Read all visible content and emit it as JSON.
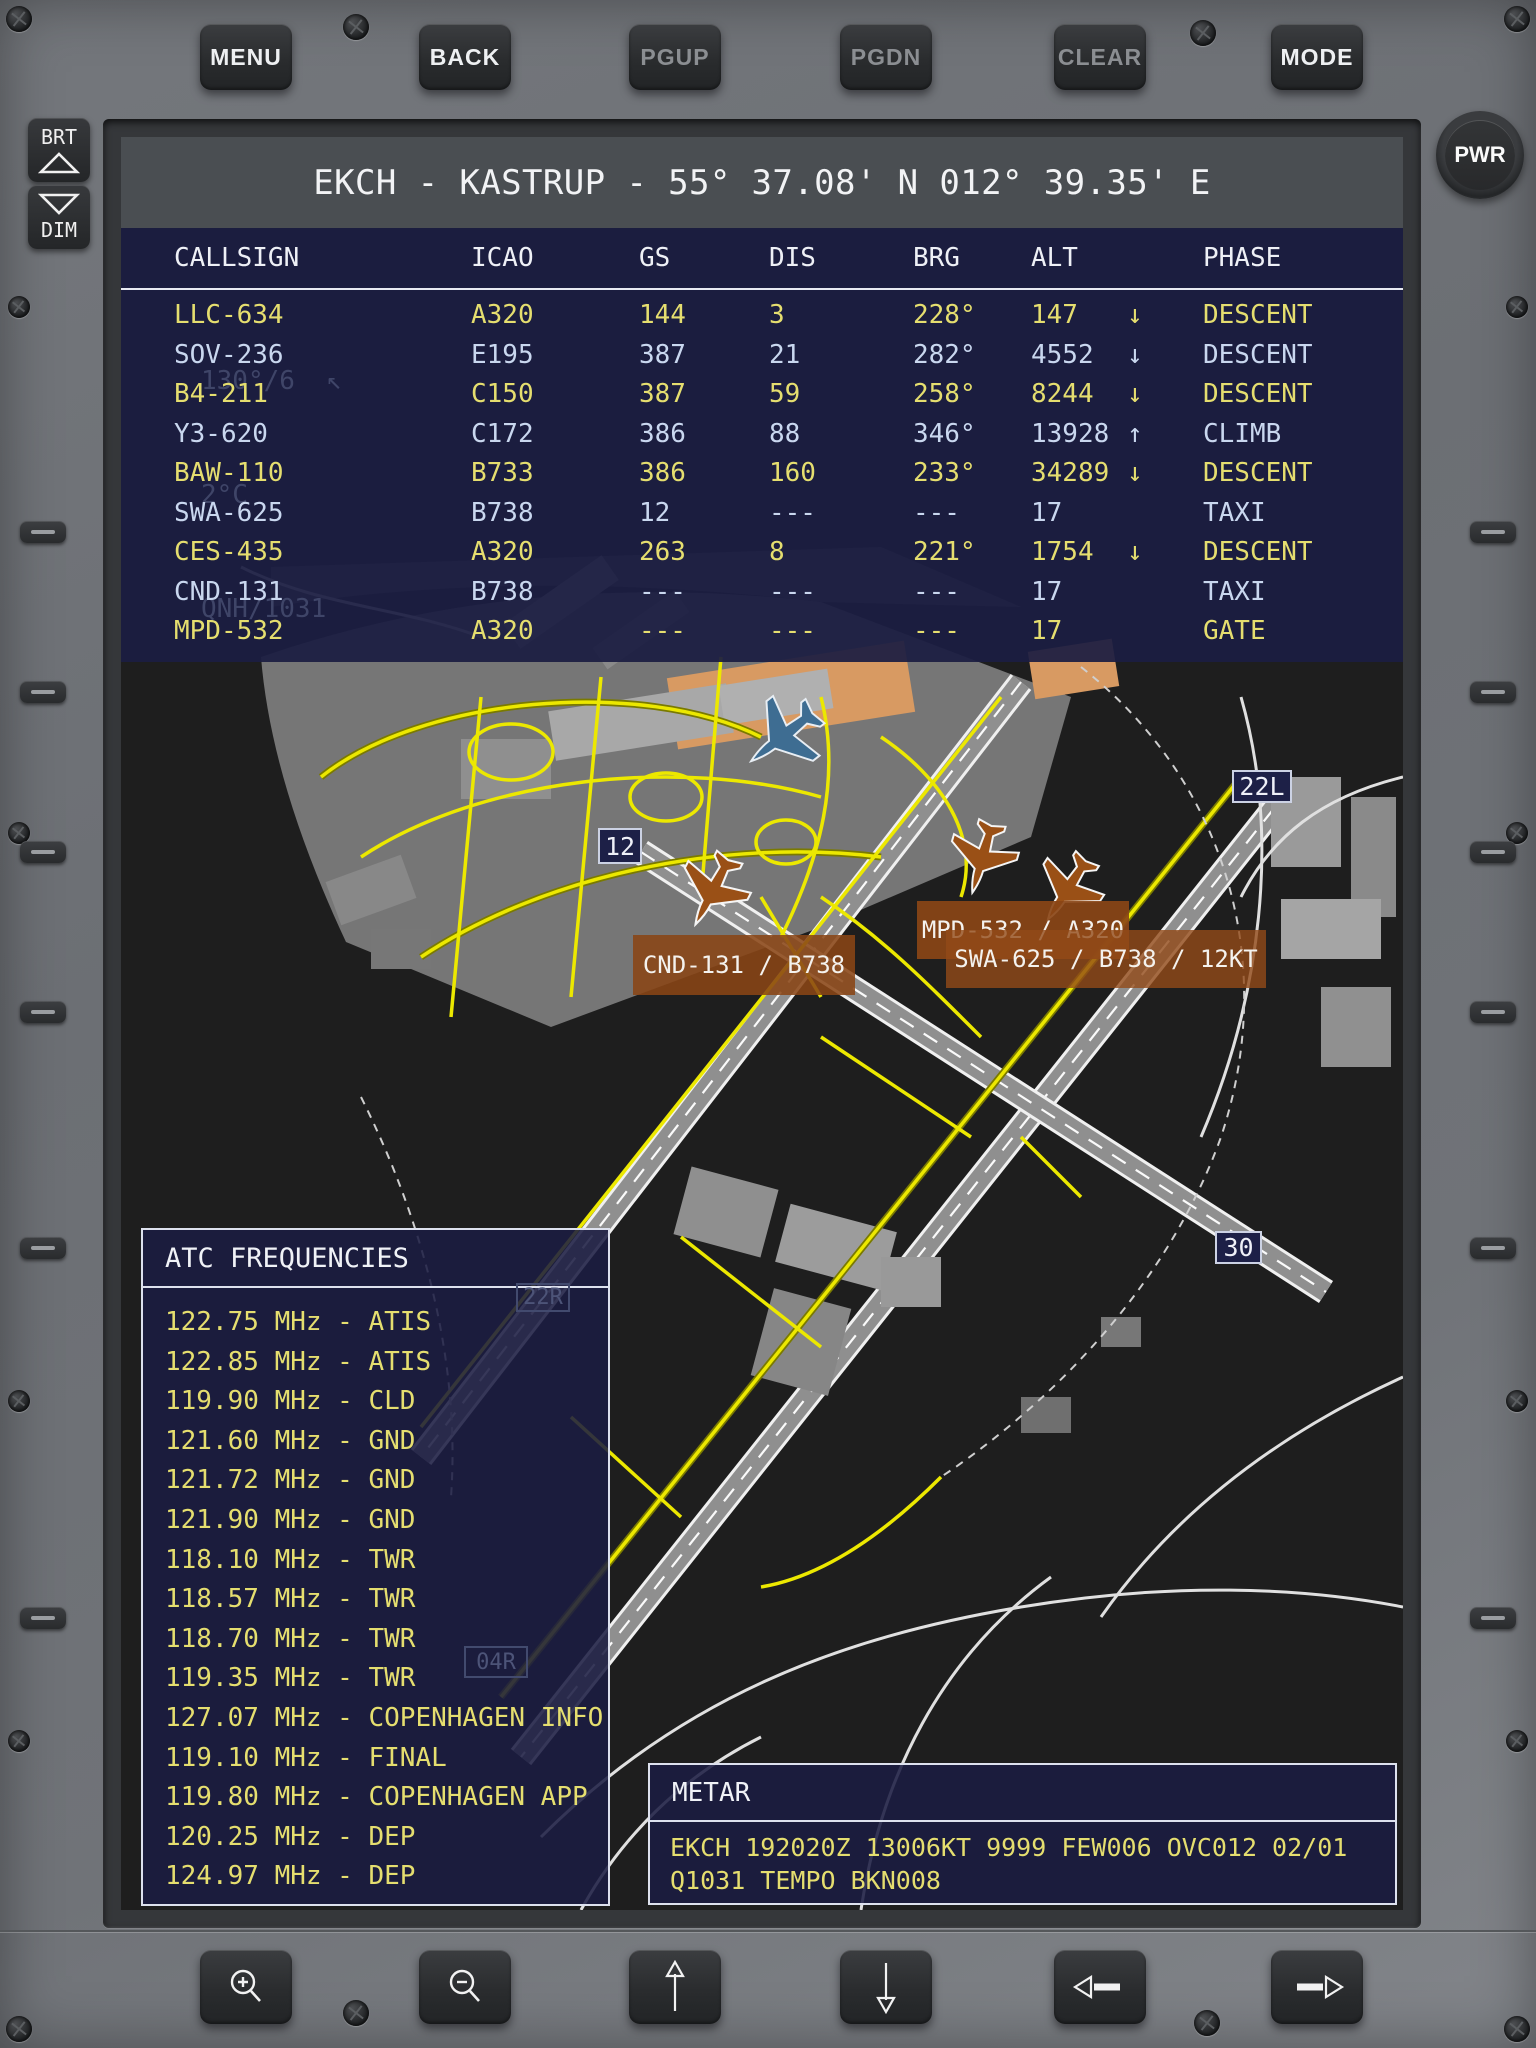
{
  "device": {
    "brightness_up": "BRT",
    "brightness_down": "DIM",
    "power": "PWR",
    "top_buttons": [
      {
        "label": "MENU",
        "enabled": true
      },
      {
        "label": "BACK",
        "enabled": true
      },
      {
        "label": "PGUP",
        "enabled": false
      },
      {
        "label": "PGDN",
        "enabled": false
      },
      {
        "label": "CLEAR",
        "enabled": false
      },
      {
        "label": "MODE",
        "enabled": true
      }
    ],
    "bottom_buttons": [
      {
        "icon": "magnifier-plus-icon",
        "action": "zoom-in"
      },
      {
        "icon": "magnifier-minus-icon",
        "action": "zoom-out"
      },
      {
        "icon": "arrow-up-icon",
        "action": "pan-up"
      },
      {
        "icon": "arrow-down-icon",
        "action": "pan-down"
      },
      {
        "icon": "arrow-left-icon",
        "action": "pan-left"
      },
      {
        "icon": "arrow-right-icon",
        "action": "pan-right"
      }
    ]
  },
  "screen": {
    "title": "EKCH - KASTRUP - 55° 37.08' N 012° 39.35' E",
    "traffic_table": {
      "columns": [
        "CALLSIGN",
        "ICAO",
        "GS",
        "DIS",
        "BRG",
        "ALT",
        "PHASE"
      ],
      "rows": [
        {
          "callsign": "LLC-634",
          "icao": "A320",
          "gs": "144",
          "dis": "3",
          "brg": "228°",
          "alt": "147",
          "trend": "↓",
          "phase": "DESCENT"
        },
        {
          "callsign": "SOV-236",
          "icao": "E195",
          "gs": "387",
          "dis": "21",
          "brg": "282°",
          "alt": "4552",
          "trend": "↓",
          "phase": "DESCENT"
        },
        {
          "callsign": "B4-211",
          "icao": "C150",
          "gs": "387",
          "dis": "59",
          "brg": "258°",
          "alt": "8244",
          "trend": "↓",
          "phase": "DESCENT"
        },
        {
          "callsign": "Y3-620",
          "icao": "C172",
          "gs": "386",
          "dis": "88",
          "brg": "346°",
          "alt": "13928",
          "trend": "↑",
          "phase": "CLIMB"
        },
        {
          "callsign": "BAW-110",
          "icao": "B733",
          "gs": "386",
          "dis": "160",
          "brg": "233°",
          "alt": "34289",
          "trend": "↓",
          "phase": "DESCENT"
        },
        {
          "callsign": "SWA-625",
          "icao": "B738",
          "gs": "12",
          "dis": "---",
          "brg": "---",
          "alt": "17",
          "trend": "",
          "phase": "TAXI"
        },
        {
          "callsign": "CES-435",
          "icao": "A320",
          "gs": "263",
          "dis": "8",
          "brg": "221°",
          "alt": "1754",
          "trend": "↓",
          "phase": "DESCENT"
        },
        {
          "callsign": "CND-131",
          "icao": "B738",
          "gs": "---",
          "dis": "---",
          "brg": "---",
          "alt": "17",
          "trend": "",
          "phase": "TAXI"
        },
        {
          "callsign": "MPD-532",
          "icao": "A320",
          "gs": "---",
          "dis": "---",
          "brg": "---",
          "alt": "17",
          "trend": "",
          "phase": "GATE"
        }
      ]
    },
    "overlay_info": {
      "wind": "130°/6  ↖",
      "temperature": "2°C",
      "qnh": "QNH/1031"
    },
    "map": {
      "runway_labels": {
        "rwy12": "12",
        "rwy22l": "22L",
        "rwy30": "30",
        "rwy22r": "22R",
        "rwy04r": "04R"
      },
      "aircraft_tags": {
        "cnd": "CND-131 / B738",
        "mpd": "MPD-532 / A320",
        "swa": "SWA-625 / B738 / 12KT"
      }
    },
    "atc_panel": {
      "title": "ATC FREQUENCIES",
      "items": [
        "122.75 MHz - ATIS",
        "122.85 MHz - ATIS",
        "119.90 MHz - CLD",
        "121.60 MHz - GND",
        "121.72 MHz - GND",
        "121.90 MHz - GND",
        "118.10 MHz - TWR",
        "118.57 MHz - TWR",
        "118.70 MHz - TWR",
        "119.35 MHz - TWR",
        "127.07 MHz - COPENHAGEN INFO",
        "119.10 MHz - FINAL",
        "119.80 MHz - COPENHAGEN APP",
        "120.25 MHz - DEP",
        "124.97 MHz - DEP"
      ]
    },
    "metar_panel": {
      "title": "METAR",
      "text": "EKCH 192020Z 13006KT 9999 FEW006 OVC012 02/01 Q1031 TEMPO BKN008"
    }
  },
  "colors": {
    "row_yellow": "#e5de6f",
    "row_blue": "#c9d7ef",
    "overlay_navy": "#1b1d42",
    "tag_brown": "#8a4516",
    "taxiway_yellow": "#e8e400",
    "runway_label_bg": "#1d2047"
  }
}
